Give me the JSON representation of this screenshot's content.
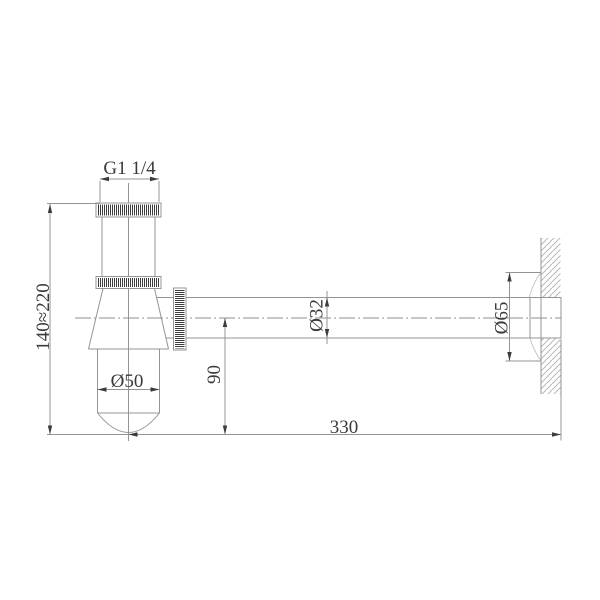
{
  "colors": {
    "background": "#ffffff",
    "line": "#949494",
    "dark": "#3c3c3c",
    "hatch": "#b8b8b8",
    "flange_arc": "#c6c6c6"
  },
  "labels": {
    "thread_size": "G1 1/4",
    "height_range": "140≈220",
    "cup_diameter": "Ø50",
    "outlet_drop": "90",
    "pipe_diameter": "Ø32",
    "flange_diameter": "Ø65",
    "pipe_length": "330"
  }
}
